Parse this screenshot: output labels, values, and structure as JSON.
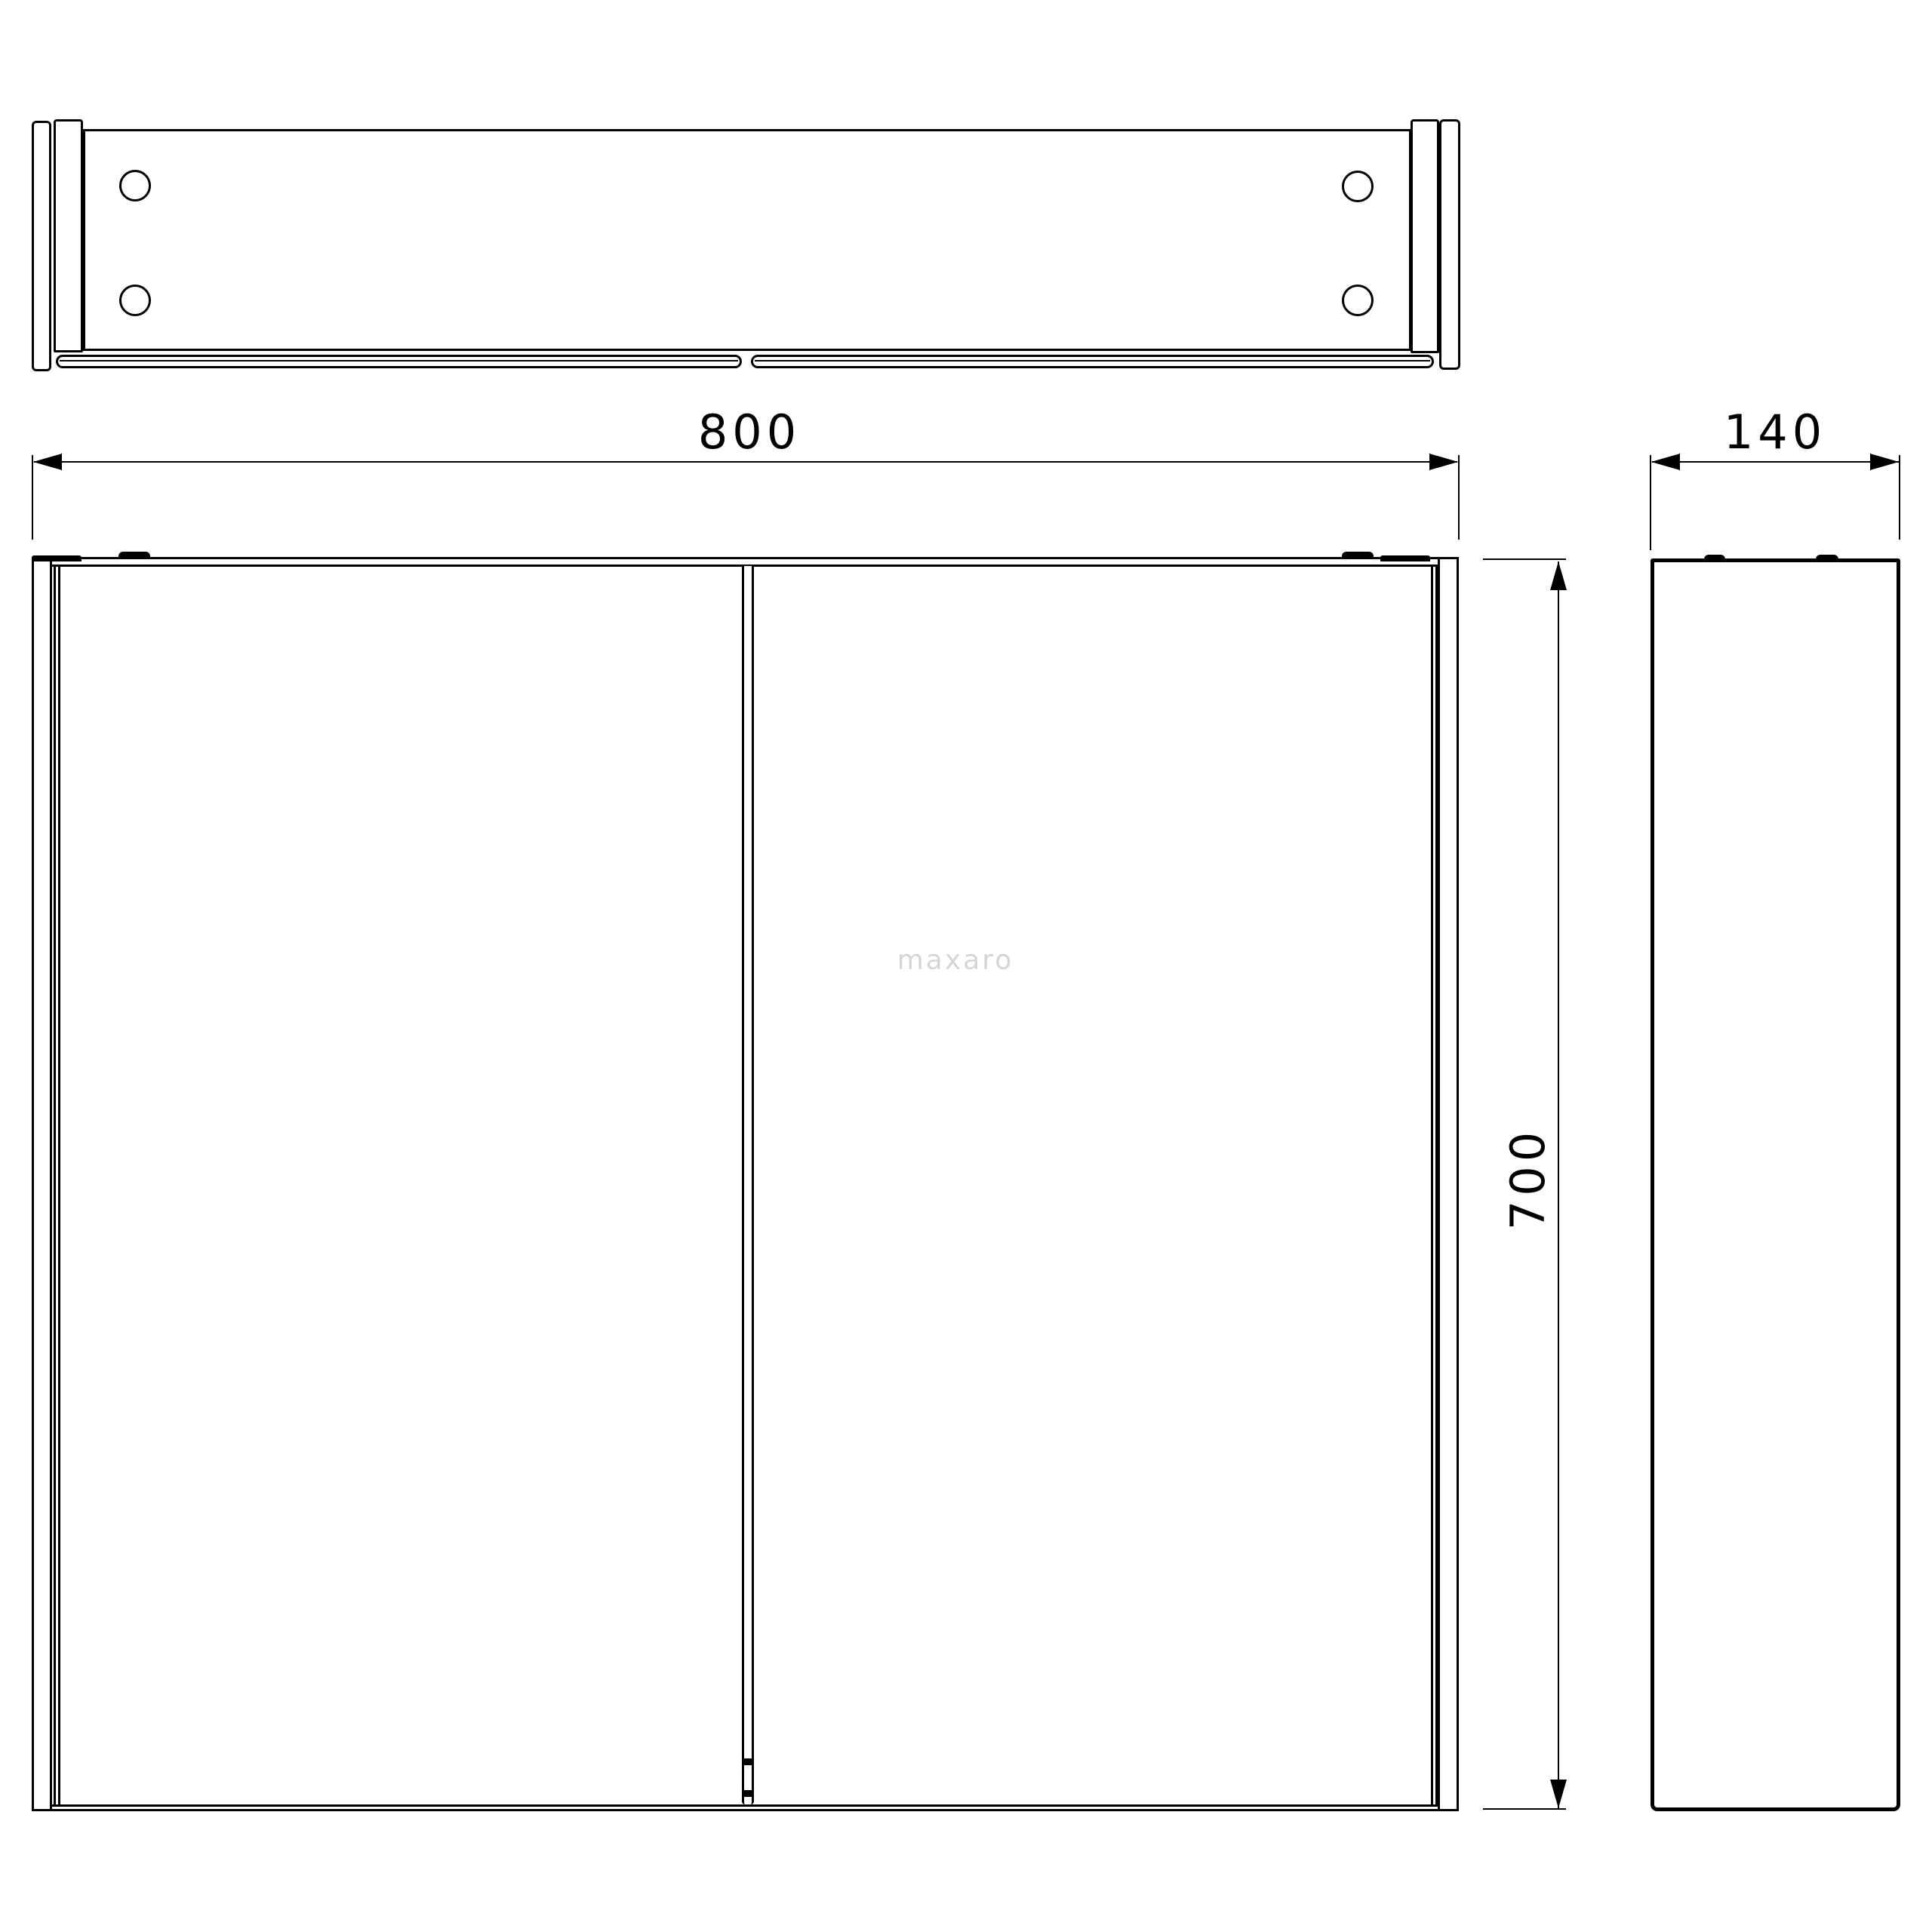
{
  "canvas": {
    "background": "#ffffff",
    "line_color": "#000000"
  },
  "watermark": {
    "text": "maxaro",
    "color": "#d5d5d5"
  },
  "drawing": {
    "type": "technical-orthographic-views",
    "views": [
      "top-view",
      "front-view",
      "side-view"
    ],
    "dimensions": {
      "width": {
        "label": "800"
      },
      "depth": {
        "label": "140"
      },
      "height": {
        "label": "700"
      }
    }
  }
}
